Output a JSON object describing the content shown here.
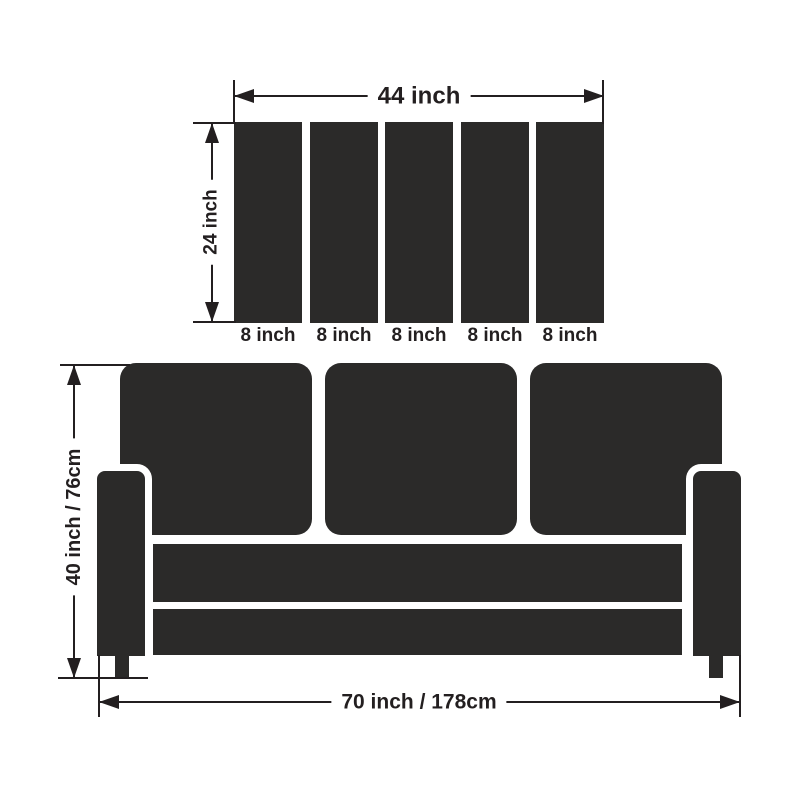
{
  "colors": {
    "shape_fill": "#2b2a29",
    "line": "#231f20",
    "background": "#ffffff"
  },
  "top_diagram": {
    "description": "wall panel set dimensions",
    "width_label": "44 inch",
    "height_label": "24 inch",
    "panel_count": 5,
    "panel_labels": [
      "8 inch",
      "8 inch",
      "8 inch",
      "8 inch",
      "8 inch"
    ]
  },
  "sofa_diagram": {
    "description": "three-seat sofa dimensions",
    "back_cushion_count": 3,
    "height_label": "40 inch / 76cm",
    "width_label": "70 inch / 178cm"
  }
}
